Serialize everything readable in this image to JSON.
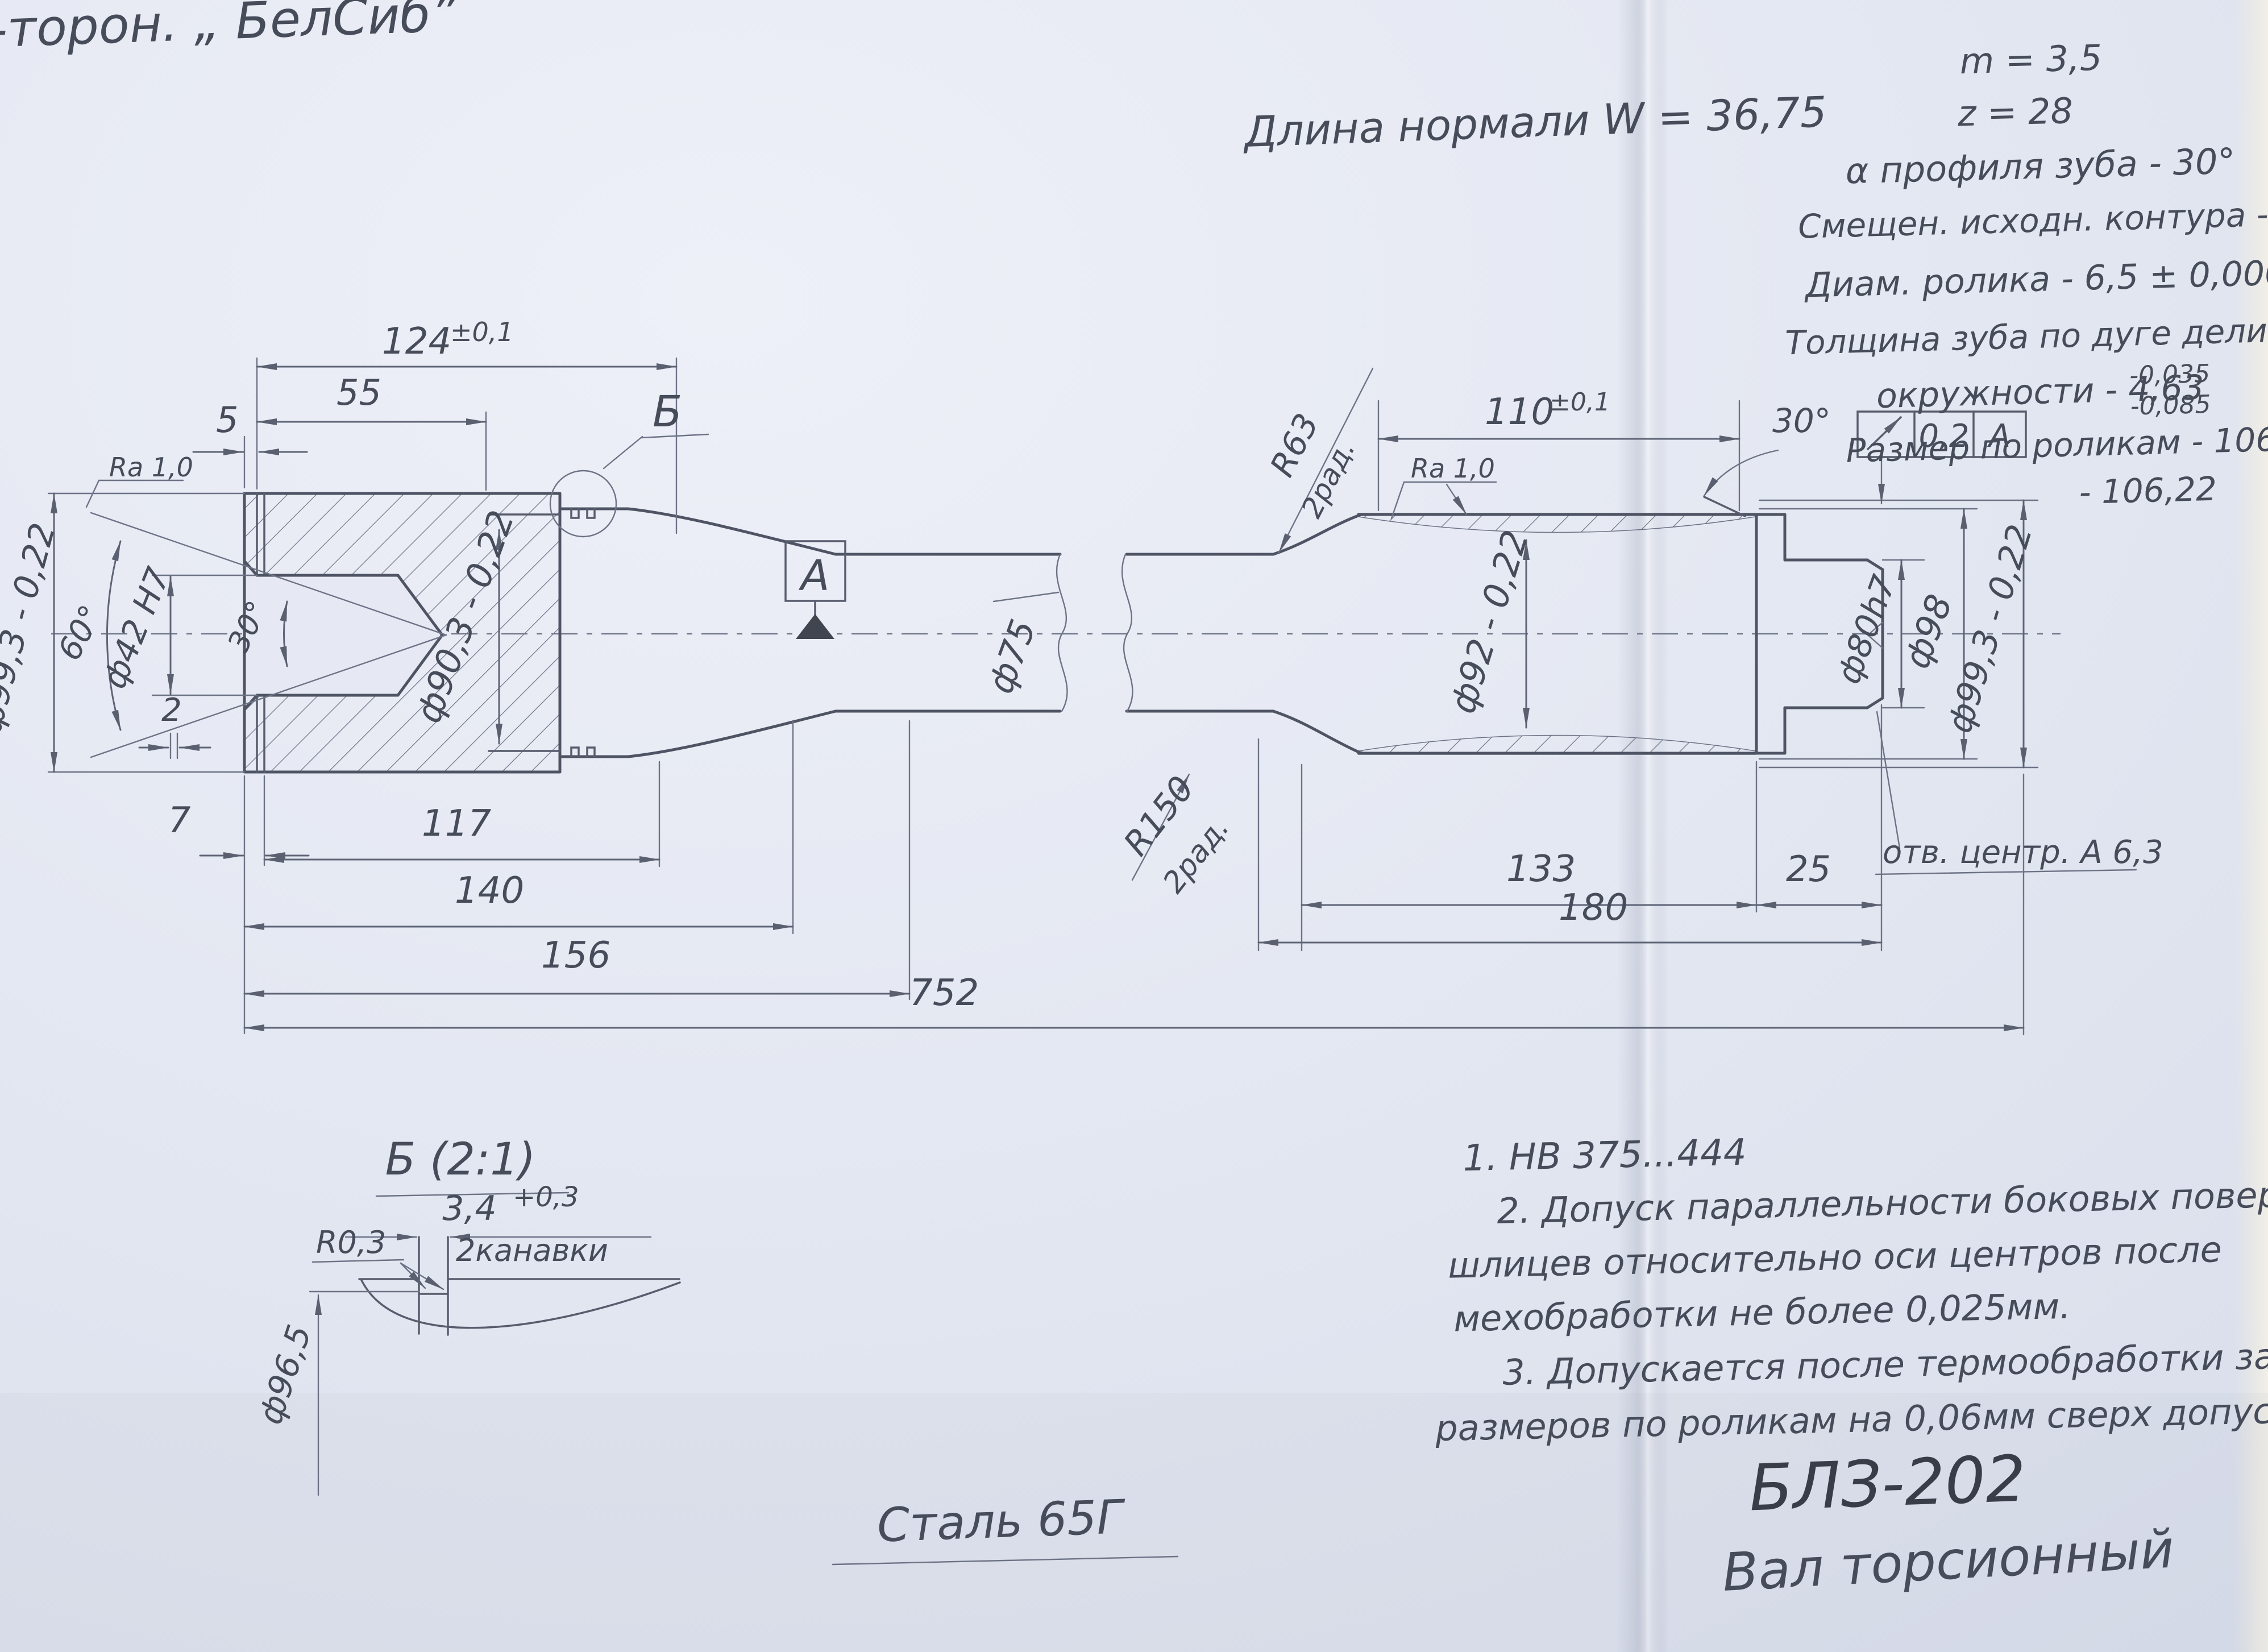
{
  "annotations": {
    "corner_title": "-торон.  „ БелСиб”",
    "normal_length": "Длина нормали  W = 36,75",
    "spline_params": {
      "module": "m = 3,5",
      "teeth_count": "z = 28",
      "profile_angle": "α профиля зуба - 30°",
      "shift": "Смещен. исходн. контура - 0,75",
      "roller_diameter": "Диам. ролика    - 6,5 ± 0,0002",
      "tooth_thickness_line1": "Толщина зуба по дуге делит.",
      "tooth_thickness_line2": "окружности   - 4,63",
      "tooth_thickness_tol_upper": "-0,035",
      "tooth_thickness_tol_lower": "-0,085",
      "roller_size_line1": "Размер по роликам - 106,32",
      "roller_size_line2": "- 106,22"
    }
  },
  "dimensions": {
    "len_124": "124",
    "len_124_tol": "±0,1",
    "len_55": "55",
    "len_5": "5",
    "len_7": "7",
    "len_117": "117",
    "len_140": "140",
    "len_156": "156",
    "len_752": "752",
    "len_110": "110",
    "len_110_tol": "±0,1",
    "len_133": "133",
    "len_25": "25",
    "len_180": "180",
    "angle_30_spline_end": "30°",
    "angle_60_bore": "60°",
    "angle_30_bore": "30°",
    "width_2": "2",
    "dia_99_3_left": "ф99,3 - 0,22",
    "dia_90_3": "ф90,3 - 0,22",
    "dia_42": "ф42 Н7",
    "dia_75": "ф75",
    "dia_92": "ф92 - 0,22",
    "dia_80": "ф80h7",
    "dia_98": "ф98",
    "dia_99_3_right": "ф99,3 - 0,22",
    "radius_63": "R63",
    "radius_63_note": "2рад.",
    "radius_150": "R150",
    "radius_150_note": "2рад.",
    "ra_left": "Ra 1,0",
    "ra_right": "Ra 1,0",
    "center_hole": "отв. центр. А 6,3",
    "datum_label": "А",
    "view_label": "Б",
    "runout_value": "0,2",
    "runout_datum": "А"
  },
  "detail_b": {
    "title": "Б (2:1)",
    "groove_width": "3,4",
    "groove_width_tol": "+0,3",
    "grooves_note": "2канавки",
    "fillet": "R0,3",
    "groove_dia": "ф96,5"
  },
  "notes": {
    "n1": "1. НВ 375...444",
    "n2a": "2. Допуск параллельности боковых поверхностей",
    "n2b": "шлицев относительно оси центров после",
    "n2c": "мехобработки не более 0,025мм.",
    "n3a": "3. Допускается после термообработки занижение",
    "n3b": "размеров по роликам на 0,06мм сверх допуска"
  },
  "title_block": {
    "material": "Сталь 65Г",
    "doc_number": "БЛЗ-202",
    "part_name": "Вал торсионный"
  }
}
